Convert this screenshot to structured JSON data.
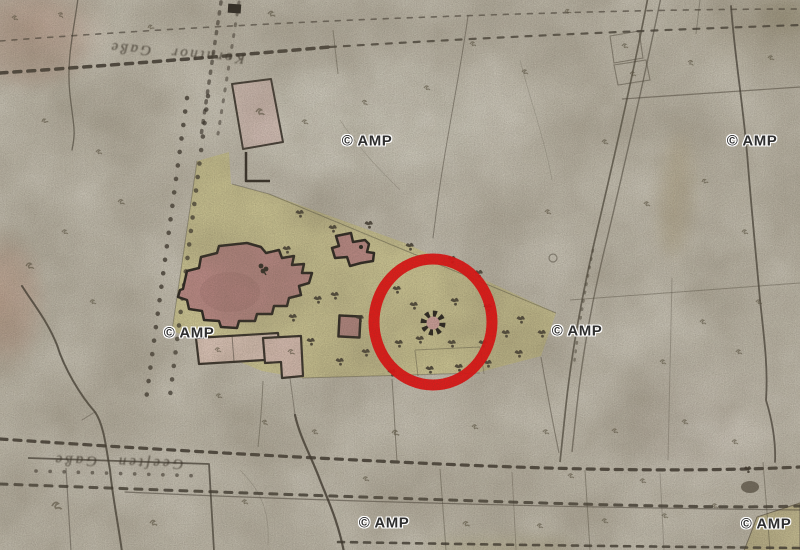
{
  "map": {
    "watermark": {
      "text": "© AMP"
    },
    "road_labels": {
      "top": "Kornthor Gaße",
      "bottom": "Geeſten Gaße"
    },
    "annotation": {
      "type": "highlight-circle",
      "color": "#e11414"
    },
    "palette": {
      "parchment": "#c6c1b3",
      "park_green": "#cec892",
      "building_red": "#bd8b87",
      "parcel_pink": "#d9c3bb",
      "ink": "#3a342c",
      "highlight_red": "#e11414",
      "watermark_ink": "#2e2e2e"
    }
  }
}
